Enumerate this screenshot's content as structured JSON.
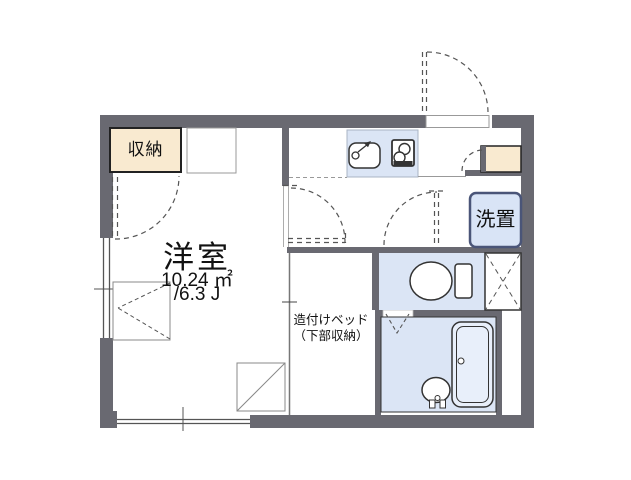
{
  "plan": {
    "rooms": {
      "closet": {
        "label": "収納"
      },
      "western_room": {
        "label": "洋室",
        "area_sqm": "10.24 ㎡",
        "area_tatami": "/6.3 J"
      },
      "built_in_bed": {
        "line1": "造付けベッド",
        "line2": "（下部収納）"
      },
      "laundry": {
        "label": "洗置"
      }
    },
    "icons": {
      "sink": "sink-icon",
      "stove": "stove-icon",
      "toilet": "toilet-icon",
      "bathtub": "bathtub-icon",
      "washbasin": "washbasin-icon",
      "pipe_space": "pipe-space-x-icon"
    },
    "colors": {
      "wall": "#696971",
      "closet_beige": "#f9ead0",
      "fixture_blue": "#dbe5f5",
      "laundry_border": "#4a5578",
      "line": "#333333",
      "dash": "#555555"
    }
  }
}
